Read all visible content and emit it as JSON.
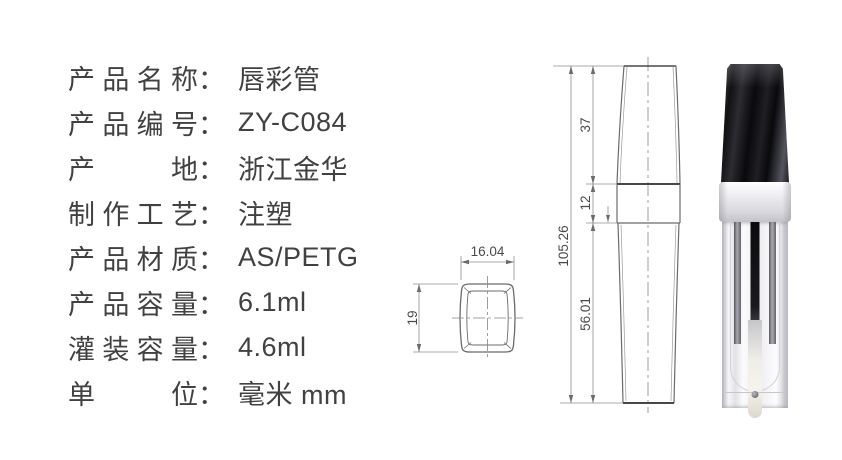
{
  "specs": {
    "colon": "：",
    "rows": [
      {
        "label": "产品名称",
        "value": "唇彩管"
      },
      {
        "label": "产品编号",
        "value": "ZY-C084"
      },
      {
        "label": "产地",
        "value": "浙江金华"
      },
      {
        "label": "制作工艺",
        "value": "注塑"
      },
      {
        "label": "产品材质",
        "value": "AS/PETG"
      },
      {
        "label": "产品容量",
        "value": "6.1ml"
      },
      {
        "label": "灌装容量",
        "value": "4.6ml"
      },
      {
        "label": "单位",
        "value": "毫米 mm"
      }
    ]
  },
  "drawing": {
    "cap_top_view": {
      "width_mm": "16.04",
      "height_mm": "19"
    },
    "side_view": {
      "total_height_mm": "105.26",
      "cap_height_mm": "37",
      "collar_height_mm": "12",
      "body_height_mm": "56.01"
    }
  },
  "colors": {
    "background": "#ffffff",
    "text": "#414141",
    "drawing_outline": "#6b6b6f",
    "drawing_heavy_line": "#48484c",
    "dimension_line": "#8f8f93",
    "cap_black": "#121214",
    "collar_silver": "#dcdce0",
    "bottle_clear": "#f2f2f5"
  }
}
